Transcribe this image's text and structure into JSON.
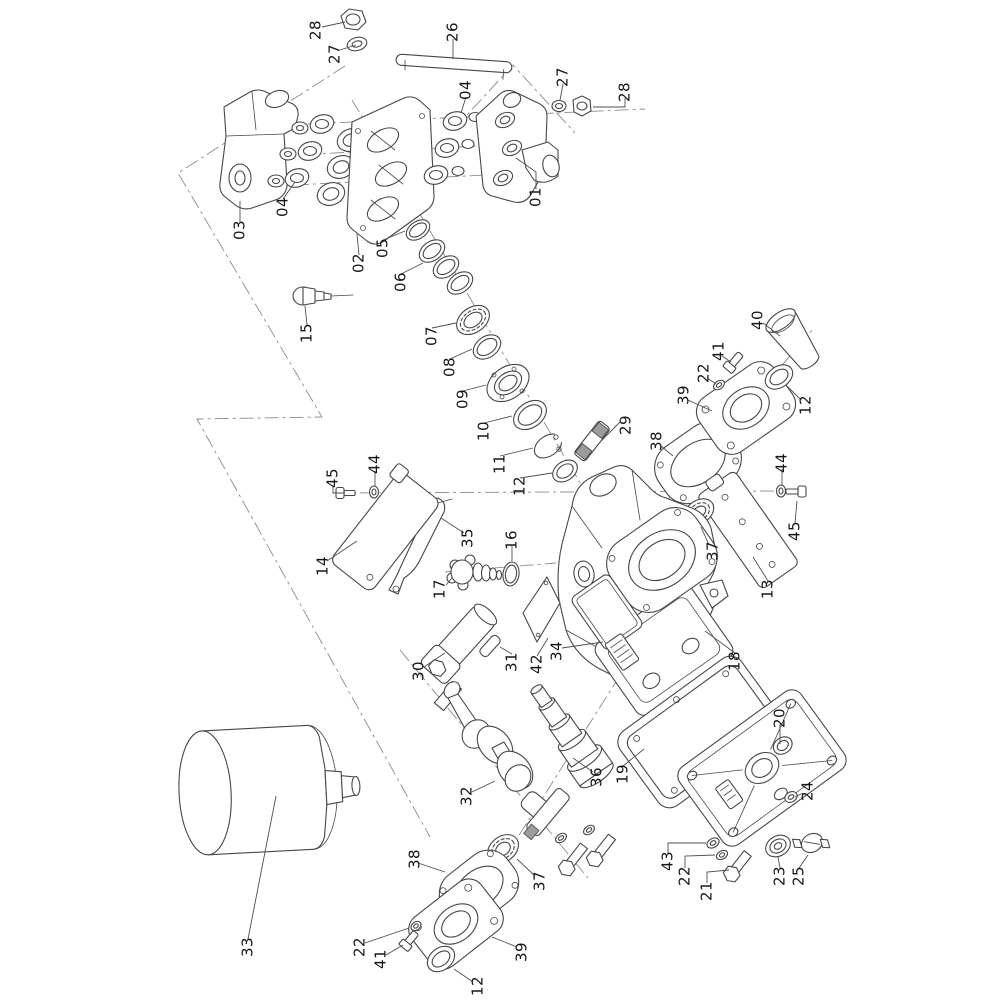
{
  "figure": {
    "type": "exploded-parts-diagram",
    "background_color": "#ffffff",
    "line_color": "#474747",
    "centerline_color": "#8b8b8b",
    "label_color": "#161616",
    "label_font_size": 15,
    "label_rotation_deg": -90
  },
  "callouts": [
    {
      "label": "28",
      "x": 316,
      "y": 30,
      "leader": [
        [
          322,
          27
        ],
        [
          345,
          22
        ]
      ]
    },
    {
      "label": "27",
      "x": 335,
      "y": 54,
      "leader": [
        [
          340,
          50
        ],
        [
          356,
          45
        ]
      ]
    },
    {
      "label": "26",
      "x": 453,
      "y": 32,
      "leader": [
        [
          453,
          39
        ],
        [
          453,
          59
        ]
      ]
    },
    {
      "label": "04",
      "x": 466,
      "y": 90,
      "leader": [
        [
          466,
          97
        ],
        [
          461,
          113
        ]
      ]
    },
    {
      "label": "27",
      "x": 563,
      "y": 77,
      "leader": [
        [
          563,
          84
        ],
        [
          560,
          100
        ]
      ]
    },
    {
      "label": "28",
      "x": 625,
      "y": 92,
      "leader": [
        [
          625,
          98
        ],
        [
          625,
          107
        ],
        [
          593,
          107
        ]
      ]
    },
    {
      "label": "01",
      "x": 536,
      "y": 197,
      "leader": [
        [
          536,
          189
        ],
        [
          536,
          172
        ],
        [
          516,
          158
        ]
      ]
    },
    {
      "label": "04",
      "x": 283,
      "y": 207,
      "leader": [
        [
          283,
          199
        ],
        [
          295,
          182
        ]
      ]
    },
    {
      "label": "03",
      "x": 240,
      "y": 230,
      "leader": [
        [
          240,
          222
        ],
        [
          240,
          201
        ]
      ]
    },
    {
      "label": "02",
      "x": 359,
      "y": 263,
      "leader": [
        [
          359,
          255
        ],
        [
          357,
          234
        ]
      ]
    },
    {
      "label": "05",
      "x": 383,
      "y": 248,
      "leader": [
        [
          383,
          240
        ],
        [
          405,
          231
        ]
      ]
    },
    {
      "label": "06",
      "x": 401,
      "y": 282,
      "leader": [
        [
          401,
          274
        ],
        [
          423,
          263
        ]
      ]
    },
    {
      "label": "15",
      "x": 307,
      "y": 333,
      "leader": [
        [
          307,
          325
        ],
        [
          305,
          306
        ]
      ]
    },
    {
      "label": "07",
      "x": 432,
      "y": 336,
      "leader": [
        [
          432,
          328
        ],
        [
          456,
          323
        ]
      ]
    },
    {
      "label": "08",
      "x": 450,
      "y": 367,
      "leader": [
        [
          450,
          359
        ],
        [
          472,
          349
        ]
      ]
    },
    {
      "label": "09",
      "x": 463,
      "y": 399,
      "leader": [
        [
          463,
          391
        ],
        [
          486,
          385
        ]
      ]
    },
    {
      "label": "10",
      "x": 484,
      "y": 431,
      "leader": [
        [
          484,
          423
        ],
        [
          512,
          416
        ]
      ]
    },
    {
      "label": "11",
      "x": 500,
      "y": 464,
      "leader": [
        [
          500,
          456
        ],
        [
          533,
          448
        ]
      ]
    },
    {
      "label": "12",
      "x": 520,
      "y": 486,
      "leader": [
        [
          520,
          478
        ],
        [
          552,
          473
        ]
      ]
    },
    {
      "label": "29",
      "x": 626,
      "y": 425,
      "leader": [
        [
          620,
          422
        ],
        [
          601,
          441
        ]
      ]
    },
    {
      "label": "40",
      "x": 758,
      "y": 320,
      "leader": [
        [
          763,
          323
        ],
        [
          780,
          336
        ]
      ]
    },
    {
      "label": "41",
      "x": 719,
      "y": 351,
      "leader": [
        [
          722,
          356
        ],
        [
          731,
          362
        ]
      ]
    },
    {
      "label": "22",
      "x": 704,
      "y": 373,
      "leader": [
        [
          707,
          378
        ],
        [
          716,
          384
        ]
      ]
    },
    {
      "label": "39",
      "x": 684,
      "y": 395,
      "leader": [
        [
          688,
          400
        ],
        [
          712,
          411
        ]
      ]
    },
    {
      "label": "12",
      "x": 806,
      "y": 405,
      "leader": [
        [
          801,
          400
        ],
        [
          787,
          386
        ]
      ]
    },
    {
      "label": "38",
      "x": 657,
      "y": 441,
      "leader": [
        [
          661,
          446
        ],
        [
          673,
          456
        ]
      ]
    },
    {
      "label": "44",
      "x": 782,
      "y": 463,
      "leader": [
        [
          782,
          469
        ],
        [
          782,
          486
        ]
      ]
    },
    {
      "label": "45",
      "x": 795,
      "y": 531,
      "leader": [
        [
          795,
          523
        ],
        [
          797,
          501
        ]
      ]
    },
    {
      "label": "37",
      "x": 713,
      "y": 551,
      "leader": [
        [
          709,
          545
        ],
        [
          701,
          527
        ]
      ]
    },
    {
      "label": "13",
      "x": 768,
      "y": 589,
      "leader": [
        [
          768,
          581
        ],
        [
          753,
          557
        ]
      ]
    },
    {
      "label": "45",
      "x": 333,
      "y": 478,
      "leader": [
        [
          333,
          486
        ],
        [
          333,
          493
        ],
        [
          345,
          493
        ]
      ]
    },
    {
      "label": "44",
      "x": 375,
      "y": 464,
      "leader": [
        [
          375,
          471
        ],
        [
          375,
          486
        ]
      ]
    },
    {
      "label": "14",
      "x": 323,
      "y": 566,
      "leader": [
        [
          327,
          561
        ],
        [
          357,
          541
        ]
      ]
    },
    {
      "label": "35",
      "x": 468,
      "y": 538,
      "leader": [
        [
          464,
          533
        ],
        [
          441,
          518
        ]
      ]
    },
    {
      "label": "16",
      "x": 512,
      "y": 540,
      "leader": [
        [
          512,
          546
        ],
        [
          512,
          561
        ]
      ]
    },
    {
      "label": "17",
      "x": 440,
      "y": 589,
      "leader": [
        [
          446,
          585
        ],
        [
          452,
          578
        ]
      ]
    },
    {
      "label": "42",
      "x": 537,
      "y": 664,
      "leader": [
        [
          537,
          656
        ],
        [
          548,
          638
        ]
      ]
    },
    {
      "label": "34",
      "x": 557,
      "y": 651,
      "leader": [
        [
          562,
          648
        ],
        [
          603,
          642
        ]
      ]
    },
    {
      "label": "18",
      "x": 735,
      "y": 661,
      "leader": [
        [
          735,
          653
        ],
        [
          705,
          631
        ]
      ]
    },
    {
      "label": "30",
      "x": 419,
      "y": 671,
      "leader": [
        [
          424,
          667
        ],
        [
          445,
          653
        ]
      ]
    },
    {
      "label": "31",
      "x": 512,
      "y": 662,
      "leader": [
        [
          512,
          654
        ],
        [
          500,
          647
        ]
      ]
    },
    {
      "label": "32",
      "x": 467,
      "y": 796,
      "leader": [
        [
          472,
          792
        ],
        [
          495,
          781
        ]
      ]
    },
    {
      "label": "36",
      "x": 597,
      "y": 777,
      "leader": [
        [
          593,
          772
        ],
        [
          573,
          758
        ]
      ]
    },
    {
      "label": "19",
      "x": 623,
      "y": 774,
      "leader": [
        [
          623,
          766
        ],
        [
          644,
          749
        ]
      ]
    },
    {
      "label": "20",
      "x": 780,
      "y": 718,
      "leader": [
        [
          780,
          724
        ],
        [
          780,
          744
        ]
      ]
    },
    {
      "label": "24",
      "x": 808,
      "y": 791,
      "leader": [
        [
          803,
          793
        ],
        [
          795,
          797
        ]
      ]
    },
    {
      "label": "43",
      "x": 668,
      "y": 861,
      "leader": [
        [
          668,
          853
        ],
        [
          668,
          843
        ],
        [
          706,
          843
        ]
      ]
    },
    {
      "label": "22",
      "x": 685,
      "y": 876,
      "leader": [
        [
          685,
          868
        ],
        [
          685,
          856
        ],
        [
          715,
          855
        ]
      ]
    },
    {
      "label": "21",
      "x": 707,
      "y": 891,
      "leader": [
        [
          707,
          883
        ],
        [
          707,
          872
        ],
        [
          729,
          870
        ]
      ]
    },
    {
      "label": "23",
      "x": 780,
      "y": 876,
      "leader": [
        [
          780,
          868
        ],
        [
          778,
          857
        ]
      ]
    },
    {
      "label": "25",
      "x": 799,
      "y": 876,
      "leader": [
        [
          799,
          868
        ],
        [
          808,
          855
        ]
      ]
    },
    {
      "label": "38",
      "x": 415,
      "y": 859,
      "leader": [
        [
          418,
          863
        ],
        [
          445,
          872
        ]
      ]
    },
    {
      "label": "37",
      "x": 540,
      "y": 881,
      "leader": [
        [
          535,
          876
        ],
        [
          517,
          859
        ]
      ]
    },
    {
      "label": "22",
      "x": 360,
      "y": 947,
      "leader": [
        [
          365,
          943
        ],
        [
          409,
          928
        ]
      ]
    },
    {
      "label": "41",
      "x": 381,
      "y": 959,
      "leader": [
        [
          386,
          955
        ],
        [
          403,
          945
        ]
      ]
    },
    {
      "label": "39",
      "x": 522,
      "y": 952,
      "leader": [
        [
          517,
          947
        ],
        [
          492,
          937
        ]
      ]
    },
    {
      "label": "12",
      "x": 478,
      "y": 986,
      "leader": [
        [
          473,
          982
        ],
        [
          454,
          969
        ]
      ]
    },
    {
      "label": "33",
      "x": 248,
      "y": 947,
      "leader": [
        [
          248,
          939
        ],
        [
          276,
          796
        ]
      ]
    }
  ]
}
